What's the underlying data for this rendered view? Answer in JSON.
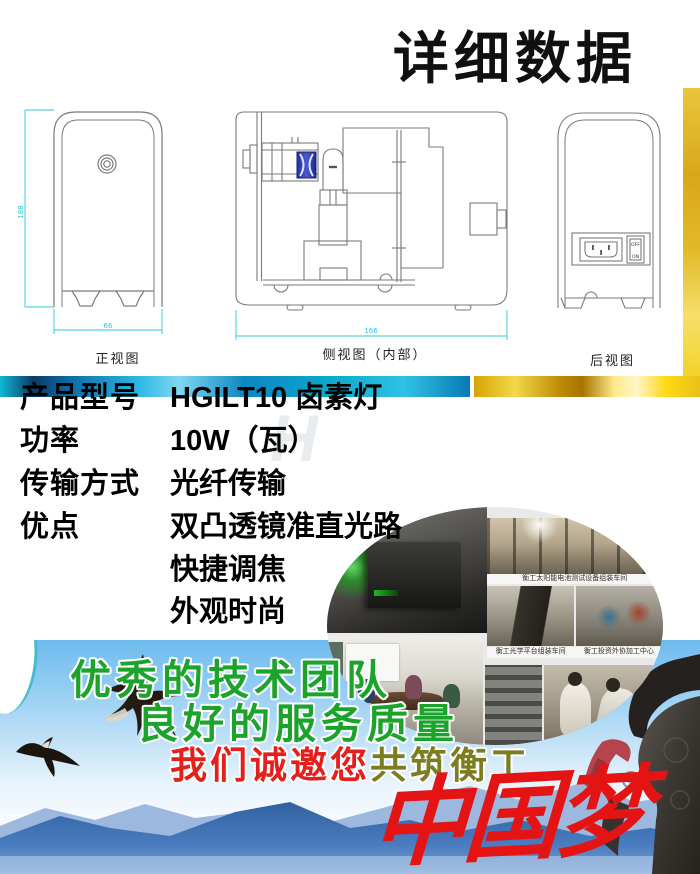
{
  "title": "详细数据",
  "drawings": {
    "front_label": "正视图",
    "front_dim_h": "188",
    "front_dim_w": "66",
    "side_label": "侧视图（内部）",
    "side_dim_w": "166",
    "rear_label": "后视图",
    "switch_off": "OFF",
    "switch_on": "ON"
  },
  "specs": {
    "rows": [
      {
        "label": "产品型号",
        "value": "HGILT10 卤素灯"
      },
      {
        "label": "功率",
        "value": "10W（瓦）"
      },
      {
        "label": "传输方式",
        "value": "光纤传输"
      },
      {
        "label": "优点",
        "value": "双凸透镜准直光路"
      },
      {
        "label": "",
        "value": "快捷调焦"
      },
      {
        "label": "",
        "value": "外观时尚"
      }
    ]
  },
  "gallery": {
    "caption_solar": "衡工太阳能电池测试设备组装车间",
    "caption_optical": "衡工光学平台组装车间",
    "caption_outsource": "衡工投资外协加工中心"
  },
  "banner": {
    "line1": "优秀的技术团队",
    "line2": "良好的服务质量",
    "line3_red": "我们诚邀您",
    "line3_olive": "共筑衡工",
    "dream": "中国梦"
  },
  "watermark": "H",
  "colors": {
    "accent_green": "#1ca32b",
    "accent_red": "#e3201b",
    "accent_olive": "#7b7d20",
    "dim_cyan": "#2cc8da",
    "gold": "#e8c118",
    "mountain_blue": "#3f6fb2"
  }
}
